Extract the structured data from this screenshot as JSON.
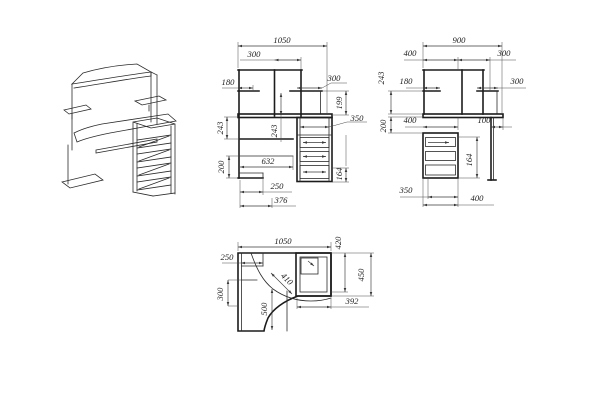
{
  "colors": {
    "background": "#ffffff",
    "drawing_line": "#1c1c1c",
    "dimension_line": "#3a3a3a"
  },
  "front": {
    "total_width": "1050",
    "center_section": "300",
    "left_shelf_depth": "180",
    "right_shelf": "300",
    "right_upper_height": "199",
    "drawer_width": "350",
    "left_upper_height": "243",
    "center_height": "243",
    "tray_width": "632",
    "left_lower_height": "200",
    "foot_width": "250",
    "base_width": "376",
    "drawer_pitch": "164"
  },
  "side": {
    "total_depth": "900",
    "left_section": "400",
    "top_right_section": "300",
    "upper_height": "243",
    "shelf_depth": "180",
    "right_shelf": "300",
    "pedestal_depth": "400",
    "overhang": "100",
    "tray_gap_height": "200",
    "drawer_pitch": "164",
    "bottom_inner": "350",
    "bottom_outer": "400"
  },
  "plan": {
    "total_width": "1050",
    "corner_shelf": "250",
    "left_wing_depth": "300",
    "curve_depth": "500",
    "corner_diagonal": "410",
    "right_inner_depth": "420",
    "right_wing_depth": "450",
    "pedestal_width": "392"
  }
}
